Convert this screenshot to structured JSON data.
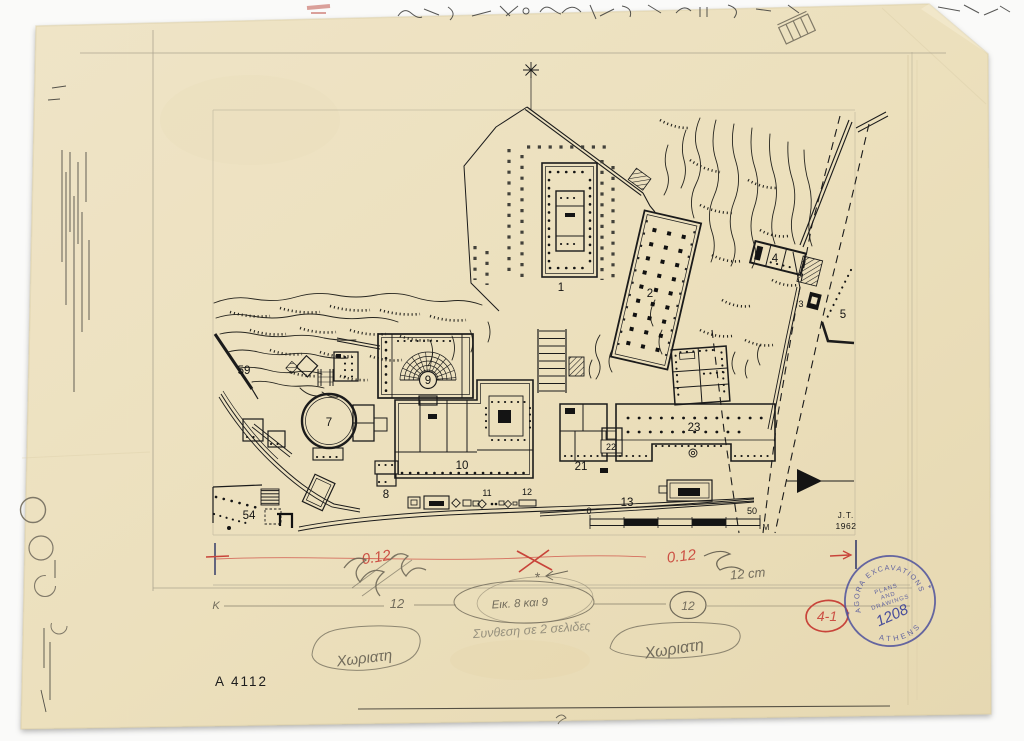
{
  "colors": {
    "paper": "#ece0be",
    "ink": "#1b1b1b",
    "pencil": "#8a8373",
    "red_pencil": "#c8443a",
    "stamp_blue": "#4d519c",
    "background": "#fafaf9"
  },
  "plan_labels": {
    "b1": "1",
    "b2": "2",
    "b3": "3",
    "b4": "4",
    "b5": "5",
    "b7": "7",
    "b8": "8",
    "b9": "9",
    "b10": "10",
    "b11": "11",
    "b12": "12",
    "b13": "13",
    "b21": "21",
    "b22": "22",
    "b23": "23",
    "b54": "54",
    "b59": "59"
  },
  "scale_bar": {
    "zero": "0",
    "fifty": "50",
    "unit": "M"
  },
  "credit": {
    "initials": "J.T.",
    "year": "1962"
  },
  "catalog_number": "A 4112",
  "stamp": {
    "arc_top": "AGORA EXCAVATIONS",
    "arc_bottom": "ATHENS",
    "star_left": "*",
    "star_right": "*",
    "center_line1": "PLANS",
    "center_line2": "AND",
    "center_line3": "DRAWINGS",
    "number": "1208"
  },
  "annotations": {
    "red_scale_left": "0.12",
    "red_scale_right": "0.12",
    "pencil_cm_note": "12 cm",
    "pencil_12": "12",
    "pencil_12_circled": "12",
    "pencil_k": "K",
    "pencil_asterisk": "*",
    "figure_note": "Εικ. 8 και 9",
    "greek_note": "Συνθεση σε 2 σελιδες",
    "greek_word_left": "Χωριατη",
    "greek_word_right": "Χωριατη",
    "red_plate_number": "4-1"
  }
}
